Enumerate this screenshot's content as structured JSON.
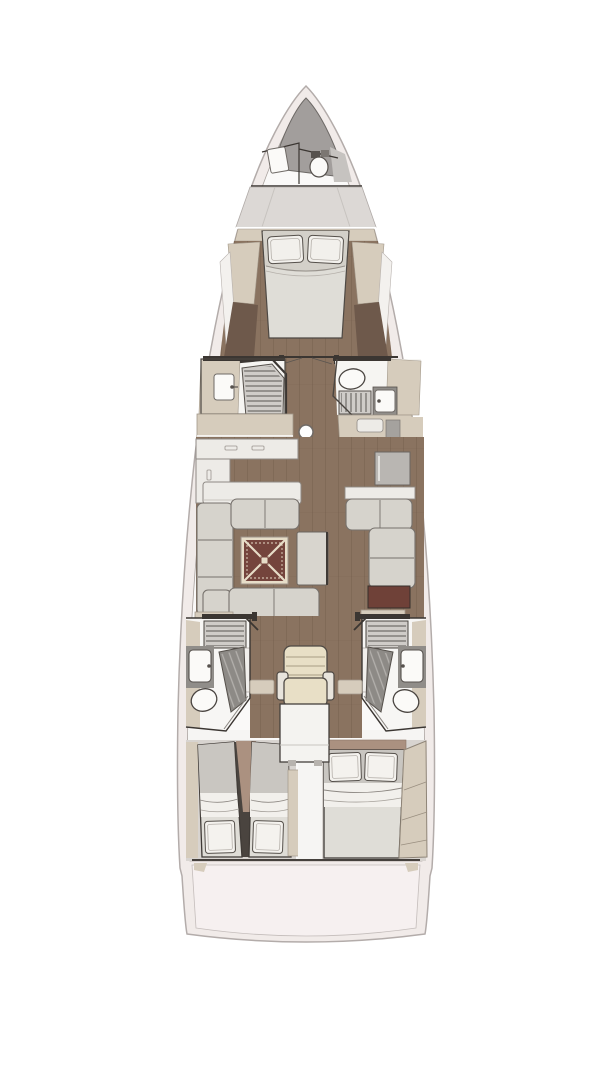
{
  "diagram": {
    "type": "yacht-interior-floor-plan",
    "view": "top-down",
    "orientation": "bow-up",
    "rooms": [
      {
        "id": "bow-locker",
        "label": "Anchor locker",
        "features": [
          "dark deck wedge"
        ]
      },
      {
        "id": "crew-head",
        "label": "Bow crew head",
        "features": [
          "toilet",
          "sink"
        ]
      },
      {
        "id": "foredeck-locker",
        "label": "Foredeck locker",
        "features": [
          "gray deck band"
        ]
      },
      {
        "id": "owner-cabin",
        "label": "Forward owner cabin",
        "features": [
          "island double bed",
          "two pillows",
          "side lockers",
          "wood floor"
        ]
      },
      {
        "id": "port-shower",
        "label": "Port midship shower room",
        "features": [
          "shower grate",
          "glass door",
          "sink"
        ]
      },
      {
        "id": "starboard-head",
        "label": "Starboard midship head",
        "features": [
          "toilet",
          "shower grate",
          "sink"
        ]
      },
      {
        "id": "galley",
        "label": "Port galley",
        "features": [
          "L-shaped counter",
          "lockers"
        ]
      },
      {
        "id": "salon",
        "label": "Salon",
        "features": [
          "port U-sofa",
          "starboard L-sofa",
          "maroon inlay table",
          "coffee bench",
          "mast post"
        ]
      },
      {
        "id": "nav-station",
        "label": "Navigation station",
        "features": [
          "helm chair",
          "chart table"
        ]
      },
      {
        "id": "port-aft-head",
        "label": "Port aft head",
        "features": [
          "shower grate",
          "shower pan",
          "sink",
          "toilet"
        ]
      },
      {
        "id": "starboard-aft-head",
        "label": "Starboard aft head",
        "features": [
          "shower grate",
          "shower pan",
          "sink",
          "toilet"
        ]
      },
      {
        "id": "port-aft-cabin",
        "label": "Port aft twin cabin",
        "features": [
          "two single beds",
          "pillows aft"
        ]
      },
      {
        "id": "starboard-aft-cabin",
        "label": "Starboard aft double cabin",
        "features": [
          "double bed",
          "pillows forward",
          "angled wardrobe"
        ]
      },
      {
        "id": "transom",
        "label": "Transom platform",
        "features": [
          "curved stern panel"
        ]
      }
    ],
    "colors": {
      "background": "#ffffff",
      "hull_shell": "#f1ebe9",
      "hull_outline": "#b3acaa",
      "deck_interior": "#faf9f8",
      "bow_wedge": "#a29e9c",
      "locker_gray": "#dcd8d5",
      "wood_floor": "#8a7360",
      "wood_floor_dark": "#6e594b",
      "cabinetry_beige": "#d6ccbc",
      "cabinetry_edge": "#a2988a",
      "counter_white": "#edebe7",
      "upholstery": "#d6d3cc",
      "upholstery_edge": "#76716c",
      "mattress": "#dfddd7",
      "mattress_shadow": "#c9c6c1",
      "linen": "#f2f0ec",
      "outline_dark": "#3b3632",
      "table_maroon": "#74443c",
      "table_inlay": "#e7ddc8",
      "grate": "#cfccc8",
      "pan_dark": "#8d8a86",
      "fixture": "#fbfaf8",
      "console_gray": "#908d89",
      "chair_cream": "#e8dfc6",
      "accent_darkred": "#6f4138",
      "headboard_tan": "#ab9180",
      "transom_panel": "#f6f0f0",
      "cabin_wall": "#d8d4d0"
    }
  }
}
